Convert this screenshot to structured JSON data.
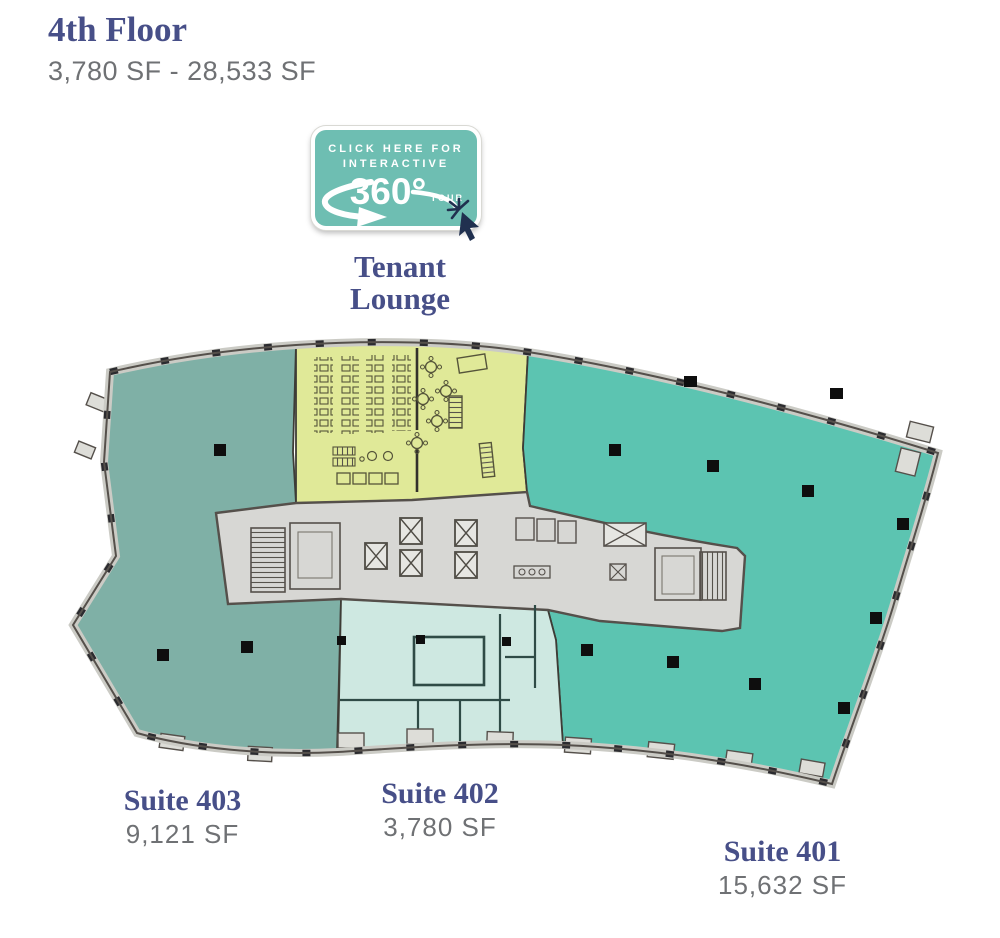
{
  "palette": {
    "title-color": "#474F88",
    "area-color": "#6F7174",
    "suite-401-fill": "#5CC4B1",
    "suite-402-fill": "#CEE8E1",
    "suite-403-fill": "#7FB0A6",
    "lounge-fill": "#E0E998",
    "core-fill": "#D7D7D4",
    "wall-band": "#CBCBC5",
    "line-dark": "#413F39",
    "badge-teal": "#6EBEB2",
    "cursor-navy": "#20304F"
  },
  "header": {
    "title": "4th Floor",
    "size_range": "3,780 SF - 28,533 SF"
  },
  "tour_badge": {
    "line1": "CLICK HERE FOR",
    "line2": "INTERACTIVE",
    "number": "360°",
    "tour": "TOUR"
  },
  "lounge_label": {
    "line1": "Tenant",
    "line2": "Lounge"
  },
  "suites": [
    {
      "name": "Suite 403",
      "area": "9,121 SF"
    },
    {
      "name": "Suite 402",
      "area": "3,780 SF"
    },
    {
      "name": "Suite 401",
      "area": "15,632 SF"
    }
  ]
}
